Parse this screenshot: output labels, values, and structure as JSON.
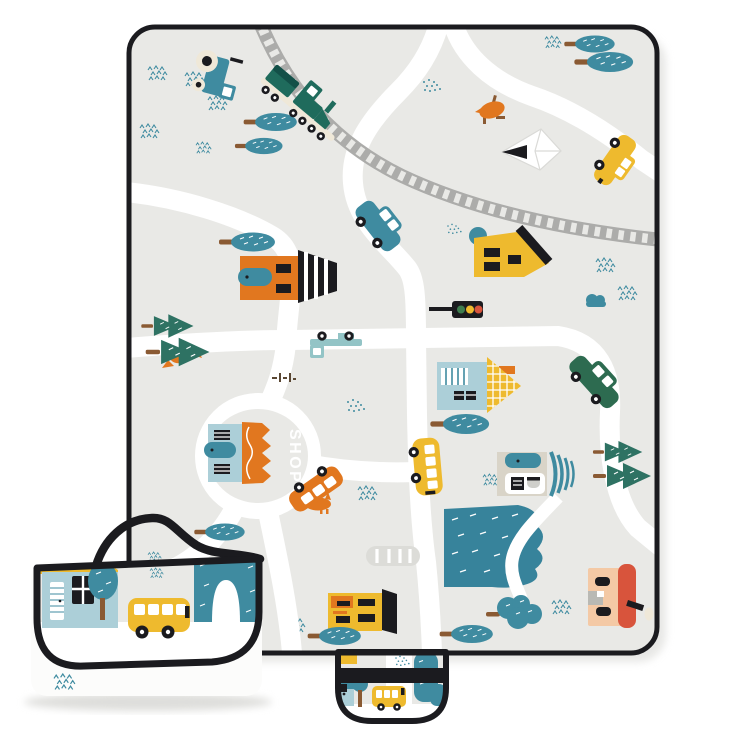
{
  "page": {
    "background": "#ffffff"
  },
  "mat": {
    "shop_label": "SHOP",
    "colors": {
      "mat_bg": "#e9e9e6",
      "road": "#ffffff",
      "rail": "#acacaa",
      "line_black": "#1b1b1f",
      "teal": "#3f8ba0",
      "teal_light": "#93c4c6",
      "pine": "#2e7263",
      "train": "#1f6b5c",
      "train_dark": "#135048",
      "car_green": "#2d6b50",
      "orange": "#e1771f",
      "yellow": "#eeba2e",
      "light_blue": "#accfd8",
      "beige": "#d9d4c8",
      "peach": "#f4c9a5",
      "red": "#d8543c",
      "brown": "#8a5a33",
      "cream": "#efe8d8",
      "stone": "#dcdcd8",
      "pond": "#37839b",
      "signal_green": "#3e7d4e",
      "shadow": "#dededb"
    }
  }
}
